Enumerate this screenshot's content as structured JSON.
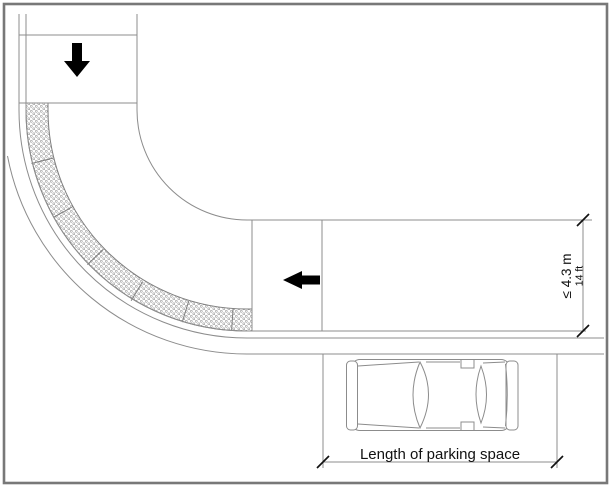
{
  "figure": {
    "kind": "road-bend-parking-diagram",
    "annotations": {
      "roadway_width_metric": "≤ 4.3 m",
      "roadway_width_imperial": "14 ft",
      "parking_space_label": "Length of parking space"
    },
    "symbols": {
      "down_arrow": "travel-direction-down-arrow",
      "left_arrow": "travel-direction-left-arrow",
      "parked_car": "parked-car-top-view",
      "hatched_band": "dotted-no-parking-band-through-bend"
    },
    "colors": {
      "background": "#ffffff",
      "frame": "#787878",
      "line": "#8c8c8c",
      "hatchdot": "#999999",
      "arrow": "#000000",
      "text": "#111111"
    }
  }
}
